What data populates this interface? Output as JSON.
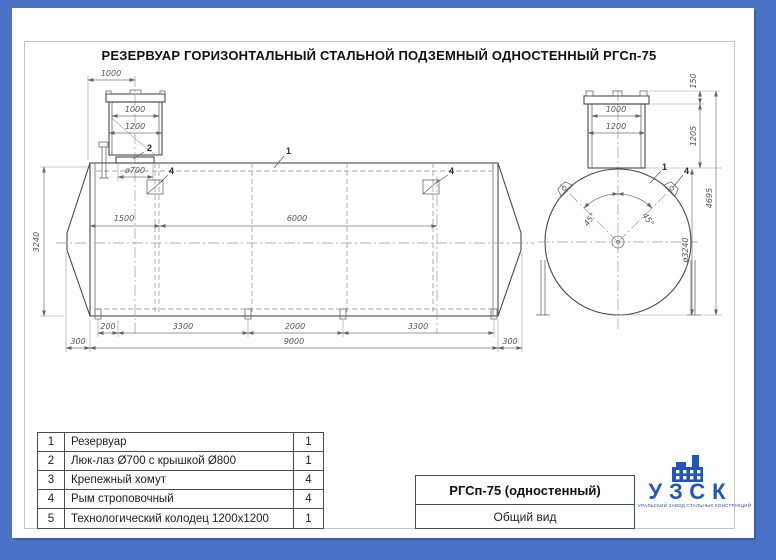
{
  "page": {
    "title": "РЕЗЕРВУАР ГОРИЗОНТАЛЬНЫЙ СТАЛЬНОЙ ПОДЗЕМНЫЙ ОДНОСТЕННЫЙ РГСп-75"
  },
  "colors": {
    "background": "#4a73c6",
    "logo_blue": "#2456b4",
    "line": "#4a4a4a"
  },
  "side": {
    "dims": {
      "offset": "1000",
      "well_inner": "1000",
      "well_outer": "1200",
      "manhole": "ø700",
      "span1": "1500",
      "span2": "6000",
      "height": "3240",
      "b1": [
        "200",
        "3300",
        "2000",
        "3300"
      ],
      "b2": [
        "300",
        "9000",
        "300"
      ]
    },
    "callouts": {
      "body": "1",
      "manhole": "2",
      "clamp": "4"
    }
  },
  "end": {
    "dims": {
      "neck_inner": "1000",
      "neck_outer": "1200",
      "cover": "150",
      "neck_h": "1205",
      "dia": "ø3240",
      "total": "4695",
      "angle": "45°"
    },
    "callouts": {
      "body": "1",
      "lug": "4"
    }
  },
  "parts_table": {
    "rows": [
      {
        "num": "1",
        "name": "Резервуар",
        "qty": "1"
      },
      {
        "num": "2",
        "name": "Люк-лаз Ø700 с крышкой Ø800",
        "qty": "1"
      },
      {
        "num": "3",
        "name": "Крепежный хомут",
        "qty": "4"
      },
      {
        "num": "4",
        "name": "Рым строповочный",
        "qty": "4"
      },
      {
        "num": "5",
        "name": "Технологический колодец 1200х1200",
        "qty": "1"
      }
    ]
  },
  "title_block": {
    "model": "РГСп-75 (одностенный)",
    "view": "Общий вид"
  },
  "logo": {
    "name": "УЗСК",
    "caption": "УРАЛЬСКИЙ ЗАВОД СТАЛЬНЫХ КОНСТРУКЦИЙ"
  }
}
